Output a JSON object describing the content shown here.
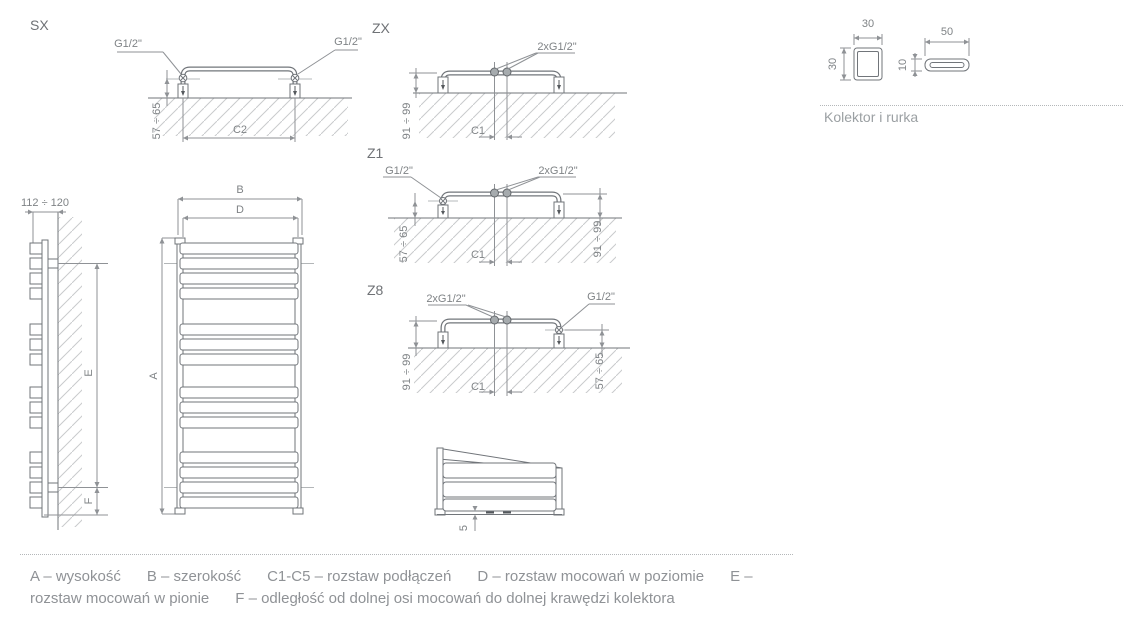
{
  "sections": {
    "sx": {
      "label": "SX"
    },
    "zx": {
      "label": "ZX"
    },
    "z1": {
      "label": "Z1"
    },
    "z8": {
      "label": "Z8"
    }
  },
  "dims": {
    "g_half": "G1/2\"",
    "g_half_x2": "2xG1/2\"",
    "range_57_65": "57 ÷ 65",
    "range_91_99": "91 ÷ 99",
    "range_112_120": "112 ÷ 120",
    "c1": "C1",
    "c2": "C2",
    "a": "A",
    "b": "B",
    "d": "D",
    "e": "E",
    "f": "F",
    "five": "5",
    "thirty": "30",
    "fifty": "50",
    "ten": "10"
  },
  "kolektor": {
    "caption": "Kolektor i rurka"
  },
  "legend": {
    "items": [
      "A – wysokość",
      "B – szerokość",
      "C1-C5 – rozstaw podłączeń",
      "D – rozstaw mocowań w poziomie",
      "E – rozstaw mocowań w pionie",
      "F –  odległość od dolnej osi mocowań do dolnej krawędzi kolektora"
    ]
  },
  "colors": {
    "line": "#71757a",
    "dimension": "#8f9296",
    "hatch": "#c9cbcd",
    "text": "#7f8386"
  }
}
